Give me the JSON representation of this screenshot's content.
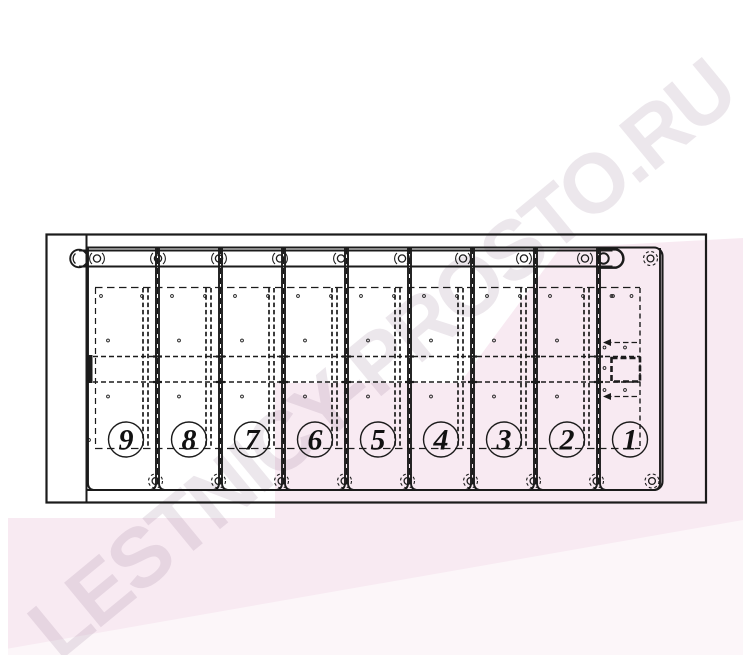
{
  "watermark": {
    "text": "LESTNICY-PROSTO.RU"
  },
  "colors": {
    "paper": "#ffffff",
    "pink": "#f8eaf2",
    "watermark": "rgba(145,112,142,0.17)",
    "line": "#1b1b1b",
    "digit": "#111111"
  },
  "diagram": {
    "slat_labels": [
      "9",
      "8",
      "7",
      "6",
      "5",
      "4",
      "3",
      "2",
      "1"
    ]
  }
}
